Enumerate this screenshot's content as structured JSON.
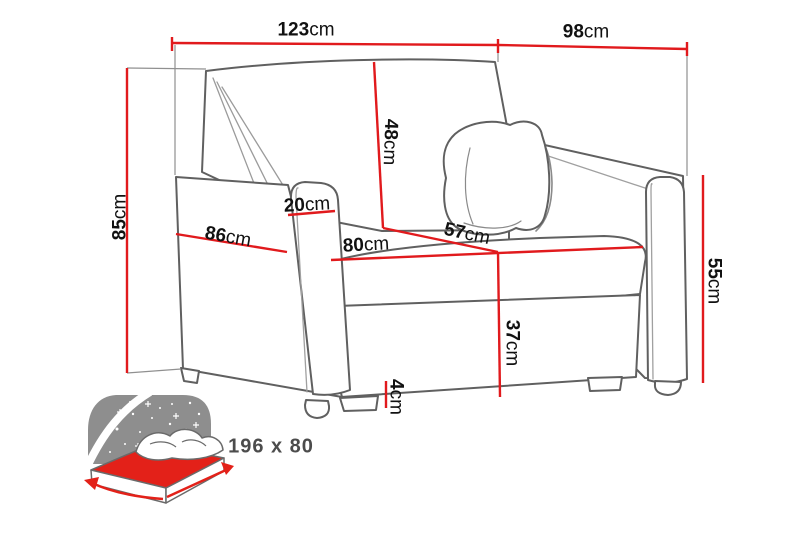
{
  "diagram": {
    "type": "furniture-dimension-diagram",
    "subject": "armchair sofa bed",
    "unit": "cm",
    "labels": {
      "w123": {
        "value": "123",
        "unit": "cm"
      },
      "d98": {
        "value": "98",
        "unit": "cm"
      },
      "h85": {
        "value": "85",
        "unit": "cm"
      },
      "b48": {
        "value": "48",
        "unit": "cm"
      },
      "a20": {
        "value": "20",
        "unit": "cm"
      },
      "s86": {
        "value": "86",
        "unit": "cm"
      },
      "s80": {
        "value": "80",
        "unit": "cm"
      },
      "s57": {
        "value": "57",
        "unit": "cm"
      },
      "a55": {
        "value": "55",
        "unit": "cm"
      },
      "s37": {
        "value": "37",
        "unit": "cm"
      },
      "l4": {
        "value": "4",
        "unit": "cm"
      }
    },
    "sleeping_area_label": "196 x 80",
    "colors": {
      "dimension_line": "#e11a1d",
      "sofa_outline": "#606060",
      "thin_line": "#a0a0a0",
      "label_text": "#111111",
      "icon_gray": "#8e8e8e",
      "icon_red": "#e32119",
      "icon_text": "#4c4c4c",
      "background": "#ffffff"
    }
  }
}
